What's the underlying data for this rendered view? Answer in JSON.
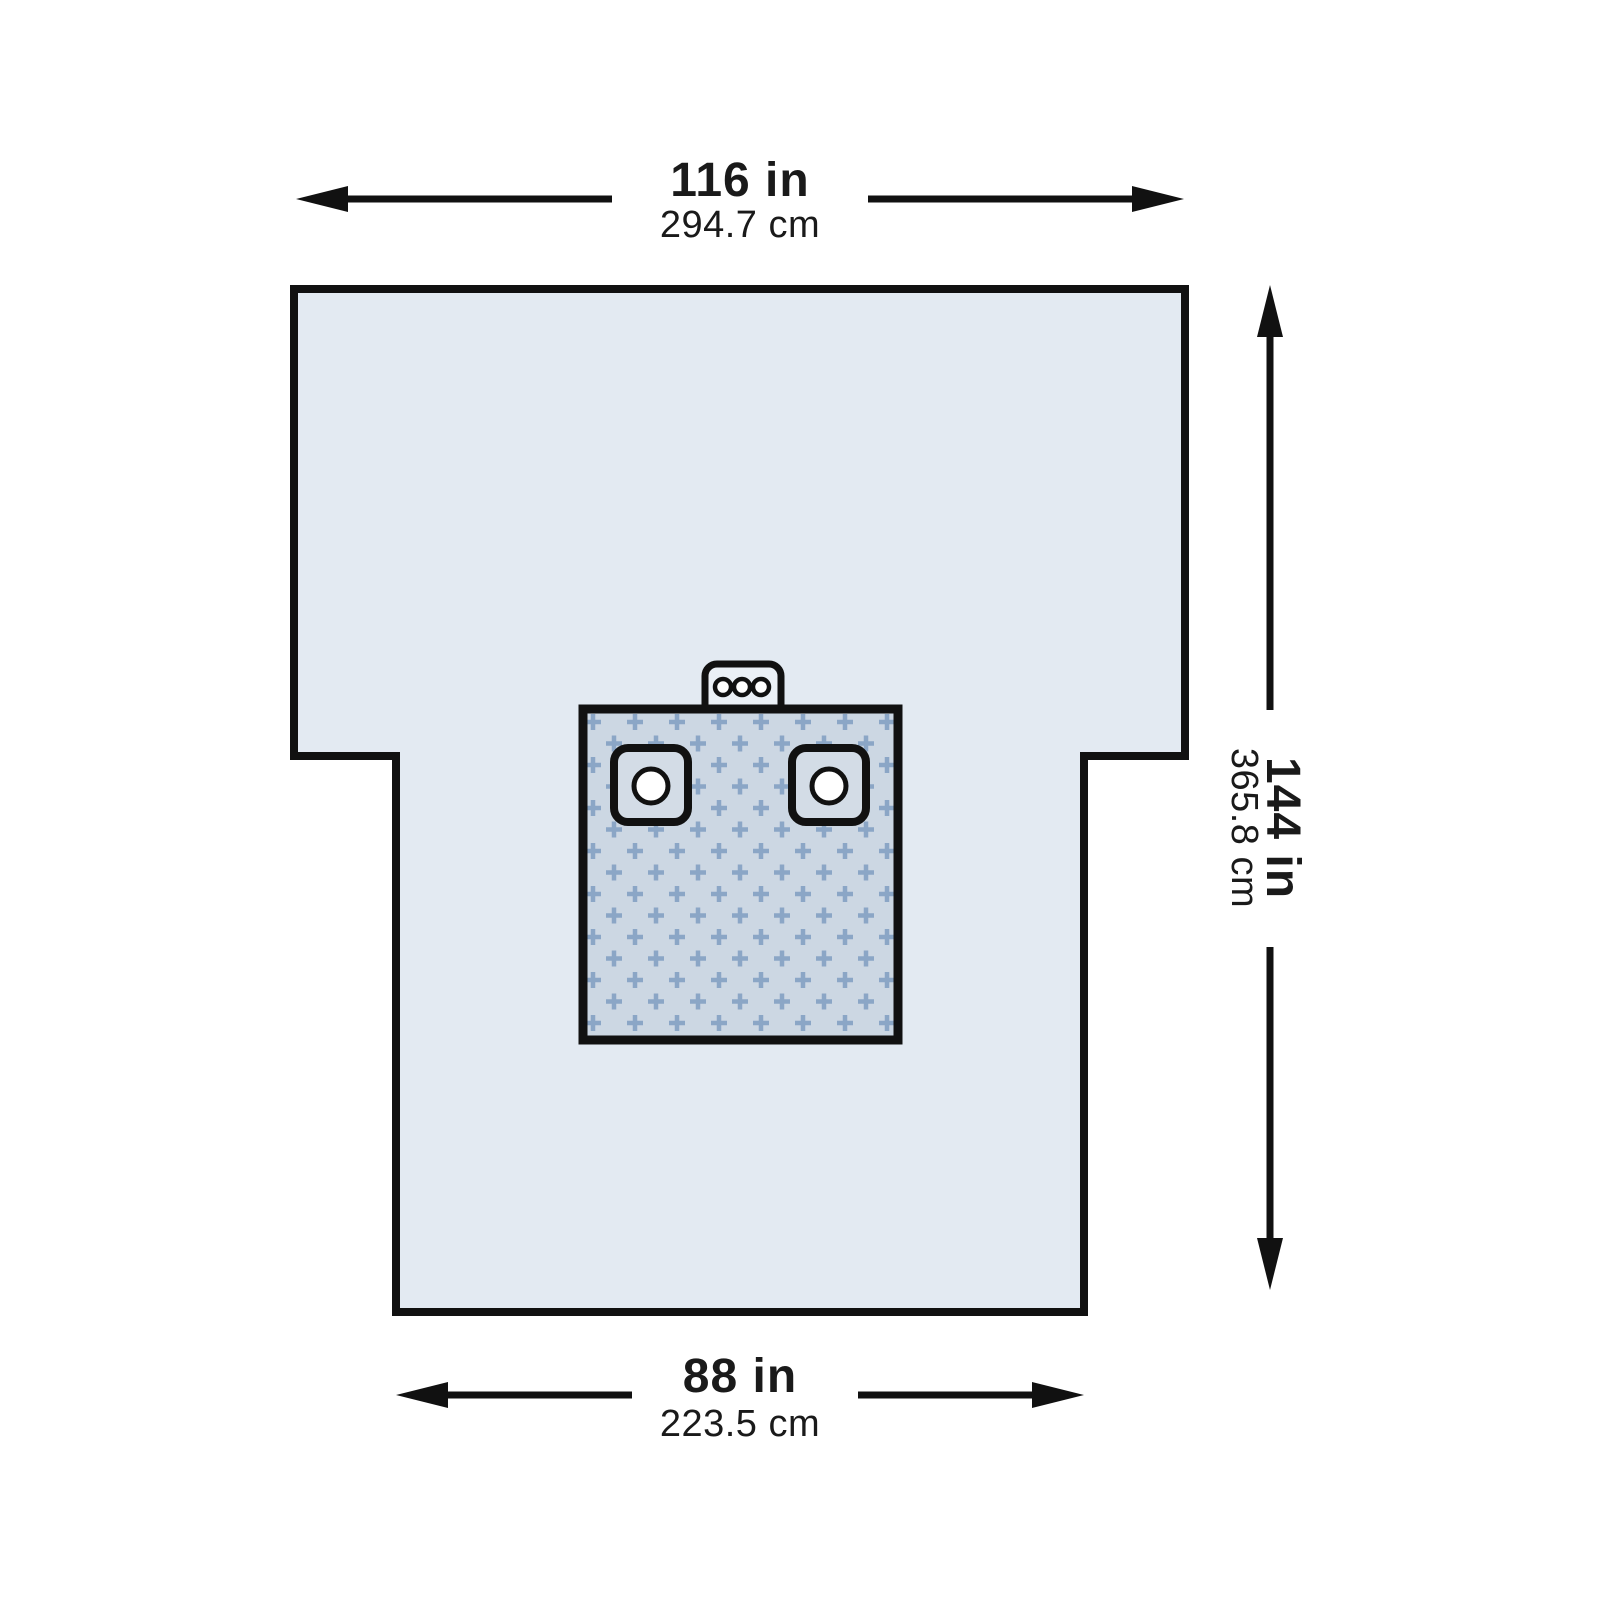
{
  "dimensions": {
    "width_top": {
      "inches": "116 in",
      "centimeters": "294.7 cm"
    },
    "height_right": {
      "inches": "144 in",
      "centimeters": "365.8 cm"
    },
    "width_bottom": {
      "inches": "88 in",
      "centimeters": "223.5 cm"
    }
  },
  "colors": {
    "background": "#ffffff",
    "outline": "#111111",
    "text": "#1a1a1a",
    "drape_fill": "#e3eaf2",
    "tab_fill": "#ebf0f6",
    "patch_fill": "#ccd7e3",
    "patch_cross": "#8ba6c6",
    "reinforcement_fill": "#d3dce6",
    "hole_fill": "#ffffff"
  }
}
